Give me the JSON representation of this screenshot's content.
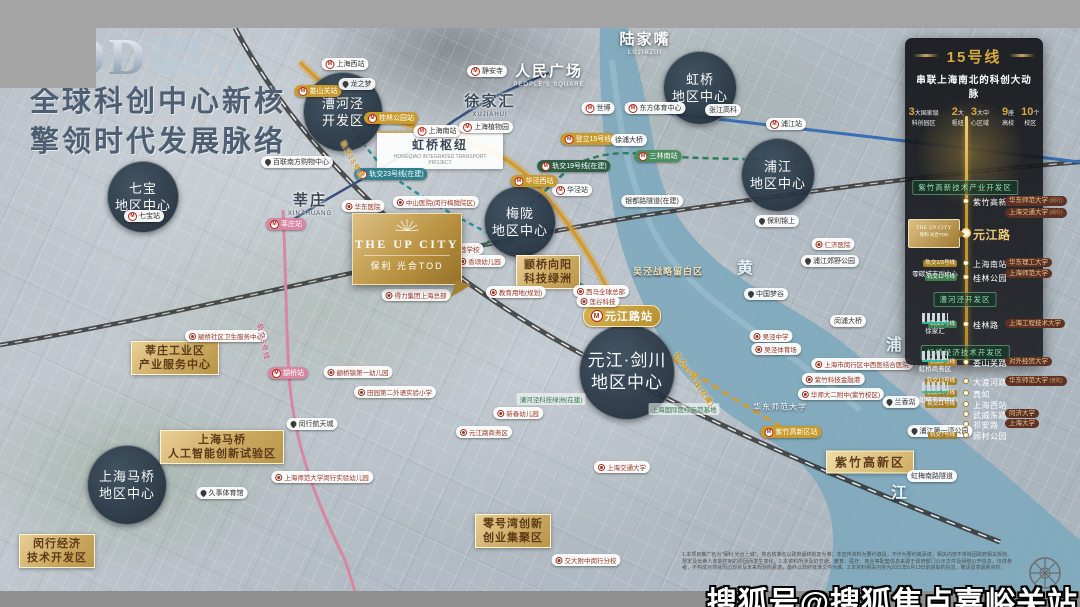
{
  "colors": {
    "gold": "#c9a227",
    "panel_bg": "#16181c",
    "circle_bg": "#22303d",
    "line15": "#d49a2e",
    "line5": "#d887a2",
    "river": "#7fa9bd",
    "green_label": "#2f7d4f",
    "red_label": "#9c3320"
  },
  "title": {
    "tod": "TOD",
    "the": "THE",
    "upcity": "UPCITY",
    "line1": "全球科创中心新核",
    "line2": "擎领时代发展脉络"
  },
  "project_logo": {
    "en": "THE UP CITY",
    "cn": "保利 光合TOD",
    "icon": "sunburst-icon"
  },
  "watermark": "搜狐号@搜狐焦点嘉峪关站",
  "disclaimer": "1.本项目推广名为“保利·光合上城”，地名核准名以政府最终批复为准；本宣传资料为要约邀请，不作为要约或承诺，相关内容不排除因政府相关规划、规定及出卖人未能控制的原因而发生变化。2.本资料所涉及的交通、教育、医疗、商业等配套信息来源于政府部门公示文件及网络公开信息，仅供参考，不构成对项目周边现状及未来规划的承诺，最终以政府批准文件为准。3.本资料相关内容为2021年6月13日前获取的信息，敬请留意最新资料。",
  "panel": {
    "title": "15号线",
    "subtitle": "串联上海南北的科创大动脉",
    "stats": [
      {
        "num": "3",
        "unit": "大国家级",
        "label": "科创园区"
      },
      {
        "num": "2",
        "unit": "大",
        "label": "枢纽"
      },
      {
        "num": "3",
        "unit": "大中",
        "label": "心区域"
      },
      {
        "num": "9",
        "unit": "座",
        "label": "高校"
      },
      {
        "num": "10",
        "unit": "个",
        "label": "校区"
      }
    ],
    "logo": {
      "en": "THE UP CITY",
      "cn": "保利 光合TOD"
    },
    "rows": [
      {
        "kind": "zone",
        "y": 72,
        "text": "紫竹高新技术产业开发区"
      },
      {
        "kind": "station",
        "y": 88,
        "name": "紫竹高新区",
        "pills": [
          {
            "t": "华东师范大学",
            "s": "(闵行)"
          },
          {
            "t": "上海交通大学",
            "s": "(闵行)"
          }
        ]
      },
      {
        "kind": "station",
        "y": 120,
        "name": "元江路",
        "big": true,
        "logo": true
      },
      {
        "kind": "station",
        "y": 150,
        "name": "上海南站",
        "tag": {
          "t": "轨交1/3号线",
          "c": "gold"
        },
        "left": "零碳城市副中心",
        "pills": [
          {
            "t": "华东理工大学"
          },
          {
            "t": "上海师范大学"
          }
        ]
      },
      {
        "kind": "station",
        "y": 164,
        "name": "桂林公园",
        "tag": {
          "t": "轨交12号线",
          "c": "green"
        }
      },
      {
        "kind": "zone",
        "y": 184,
        "text": "漕河泾开发区"
      },
      {
        "kind": "station",
        "y": 211,
        "name": "桂林路",
        "tag": {
          "t": "轨交9号线",
          "c": "green"
        },
        "lefticon": "徐家汇",
        "pills": [
          {
            "t": "上海工程技术大学"
          }
        ]
      },
      {
        "kind": "zone",
        "y": 237,
        "text": "虹桥经济技术开发区"
      },
      {
        "kind": "station",
        "y": 249,
        "name": "娄山关路",
        "tag": {
          "t": "轨交2号线",
          "c": "gold"
        },
        "lefticon": "虹桥商务区",
        "pills": [
          {
            "t": "对外经贸大学"
          }
        ]
      },
      {
        "kind": "station",
        "y": 268,
        "name": "大渡河路",
        "tag": {
          "t": "轨交13号线",
          "c": "gold"
        },
        "pills": [
          {
            "t": "华东师范大学",
            "s": "(普陀)"
          }
        ]
      },
      {
        "kind": "station",
        "y": 280,
        "name": "真如",
        "tag": {
          "t": "轨交14号线",
          "c": "gold"
        },
        "lefticon": "真如城市副中心"
      },
      {
        "kind": "station",
        "y": 291,
        "name": "上海西站",
        "tag": {
          "t": "轨交11号线",
          "c": "gold"
        }
      },
      {
        "kind": "station",
        "y": 301,
        "name": "武威东路",
        "pills": [
          {
            "t": "同济大学"
          }
        ]
      },
      {
        "kind": "station",
        "y": 311,
        "name": "祁安路",
        "pills": [
          {
            "t": "上海大学"
          }
        ]
      },
      {
        "kind": "station",
        "y": 322,
        "name": "顾村公园",
        "tag": {
          "t": "轨交7号线",
          "c": "gold"
        }
      }
    ]
  },
  "map": {
    "labels": [
      {
        "k": "circle",
        "t": "虹桥\n地区中心",
        "x": 700,
        "y": 88,
        "r": 37,
        "n": "circle-hongqiao-center"
      },
      {
        "k": "circle",
        "t": "漕河泾\n开发区",
        "x": 343,
        "y": 112,
        "r": 40,
        "n": "circle-caohejing"
      },
      {
        "k": "circle",
        "t": "七宝\n地区中心",
        "x": 143,
        "y": 197,
        "r": 36,
        "n": "circle-qibao-center"
      },
      {
        "k": "circle",
        "t": "梅陇\n地区中心",
        "x": 520,
        "y": 222,
        "r": 36,
        "n": "circle-meilong-center"
      },
      {
        "k": "circle",
        "t": "浦江\n地区中心",
        "x": 778,
        "y": 175,
        "r": 37,
        "n": "circle-pujiang-center"
      },
      {
        "k": "circle",
        "t": "元江·剑川\n地区中心",
        "x": 627,
        "y": 372,
        "r": 48,
        "lg": true,
        "n": "circle-yuanjiang-jianchuan-center"
      },
      {
        "k": "circle",
        "t": "上海马桥\n地区中心",
        "x": 127,
        "y": 485,
        "r": 40,
        "n": "circle-maqiao-center"
      },
      {
        "k": "cwhite",
        "t": "陆家嘴",
        "e": "LUJIAZUI",
        "x": 645,
        "y": 42,
        "n": "label-lujiazui"
      },
      {
        "k": "cwhite",
        "t": "人民广场",
        "e": "PEOPLE'S SQUARE",
        "x": 549,
        "y": 74,
        "n": "label-peoples-square"
      },
      {
        "k": "cdark",
        "t": "徐家汇",
        "e": "XUJIAHUI",
        "x": 490,
        "y": 104,
        "n": "label-xujiahui"
      },
      {
        "k": "cdark",
        "t": "莘庄",
        "e": "XINZHUANG",
        "x": 310,
        "y": 203,
        "n": "label-xinzhuang"
      },
      {
        "k": "white",
        "t": "张江高科",
        "x": 723,
        "y": 110,
        "n": "label-zhangjiang-hi-tech"
      },
      {
        "k": "hub",
        "t": "虹桥枢纽",
        "e": "HONGQIAO INTEGRATED TRANSPORT PROJECT",
        "x": 440,
        "y": 150,
        "n": "label-hongqiao-hub"
      },
      {
        "k": "gbox",
        "t": "莘庄工业区\n产业服务中心",
        "x": 175,
        "y": 358,
        "n": "zone-xinzhuang-industrial"
      },
      {
        "k": "gbox",
        "t": "上海马桥\n人工智能创新试验区",
        "x": 222,
        "y": 447,
        "n": "zone-maqiao-ai"
      },
      {
        "k": "gbox",
        "t": "颛桥向阳\n科技绿洲",
        "x": 548,
        "y": 272,
        "n": "zone-zhuanqiao-xiangyang"
      },
      {
        "k": "gbox",
        "t": "零号湾创新\n创业集聚区",
        "x": 513,
        "y": 531,
        "n": "zone-lingang-zero-bay"
      },
      {
        "k": "gbox",
        "t": "闵行经济\n技术开发区",
        "x": 57,
        "y": 551,
        "n": "zone-minhang-etdz"
      },
      {
        "k": "gline",
        "t": "紫竹高新区",
        "x": 870,
        "y": 462,
        "n": "zone-zizhu-hi-tech"
      },
      {
        "k": "metro",
        "c": "w",
        "t": "上海西站",
        "x": 345,
        "y": 64,
        "n": "station-shanghai-west"
      },
      {
        "k": "metro",
        "c": "w",
        "t": "静安寺",
        "x": 487,
        "y": 71,
        "n": "station-jingansi"
      },
      {
        "k": "metro",
        "c": "w",
        "t": "上海南站",
        "x": 437,
        "y": 131,
        "n": "station-shanghai-south"
      },
      {
        "k": "metro",
        "c": "w",
        "t": "上海植物园",
        "x": 486,
        "y": 127,
        "n": "station-botanical-garden"
      },
      {
        "k": "metro",
        "c": "w",
        "t": "世博",
        "x": 598,
        "y": 108,
        "n": "station-expo"
      },
      {
        "k": "metro",
        "c": "w",
        "t": "东方体育中心",
        "x": 655,
        "y": 108,
        "n": "station-oriental-sports-center"
      },
      {
        "k": "metro",
        "c": "w",
        "t": "七宝站",
        "x": 144,
        "y": 216,
        "n": "station-qibao"
      },
      {
        "k": "metro",
        "c": "w",
        "t": "浦江站",
        "x": 786,
        "y": 124,
        "n": "station-pujiang"
      },
      {
        "k": "metro",
        "c": "w",
        "t": "华泾站",
        "x": 572,
        "y": 190,
        "n": "station-huajing"
      },
      {
        "k": "metro",
        "c": "g",
        "t": "娄山关站",
        "x": 318,
        "y": 91,
        "n": "station-loushanguan"
      },
      {
        "k": "metro",
        "c": "g",
        "t": "桂林公园站",
        "x": 391,
        "y": 118,
        "n": "station-guilin-park"
      },
      {
        "k": "metro",
        "c": "g",
        "t": "华泾西站",
        "x": 534,
        "y": 181,
        "n": "station-huajing-west"
      },
      {
        "k": "metro",
        "c": "g",
        "t": "紫竹高新区站",
        "x": 791,
        "y": 432,
        "n": "station-zizhu-hi-tech"
      },
      {
        "k": "metro",
        "c": "g",
        "t": "登立15号线",
        "x": 588,
        "y": 139,
        "n": "callout-line15"
      },
      {
        "k": "metro",
        "c": "p",
        "t": "莘庄站",
        "x": 286,
        "y": 224,
        "n": "station-xinzhuang"
      },
      {
        "k": "metro",
        "c": "p",
        "t": "颛桥站",
        "x": 288,
        "y": 373,
        "n": "station-zhuanqiao"
      },
      {
        "k": "metro",
        "c": "gr",
        "t": "三林南站",
        "x": 658,
        "y": 156,
        "n": "station-sanlin-south"
      },
      {
        "k": "metro",
        "c": "dg",
        "t": "轨交19号线(在建)",
        "x": 574,
        "y": 166,
        "n": "line19-under-construction"
      },
      {
        "k": "metro",
        "c": "tl",
        "t": "轨交23号线(在建)",
        "x": 391,
        "y": 174,
        "n": "line23-under-construction"
      },
      {
        "k": "metro",
        "c": "big",
        "t": "元江路站",
        "x": 622,
        "y": 316,
        "n": "station-yuanjiang-road"
      },
      {
        "k": "white",
        "t": "徐浦大桥",
        "x": 629,
        "y": 140,
        "n": "label-xupu-bridge"
      },
      {
        "k": "white",
        "t": "银都路隧道(在建)",
        "x": 652,
        "y": 201,
        "n": "label-yindu-tunnel"
      },
      {
        "k": "white",
        "t": "闵浦大桥",
        "x": 848,
        "y": 321,
        "n": "label-minpu-bridge"
      },
      {
        "k": "white",
        "t": "虹梅南路隧道",
        "x": 932,
        "y": 476,
        "n": "label-hongmei-tunnel"
      },
      {
        "k": "white",
        "t": "颛桥剪纸文化公园",
        "x": 401,
        "y": 277,
        "ic": 1,
        "n": "label-zhuanqiao-papercut-park"
      },
      {
        "k": "pin",
        "t": "龙之梦",
        "x": 357,
        "y": 84,
        "n": "poi-longemont"
      },
      {
        "k": "pin",
        "t": "百联南方购物中心",
        "x": 297,
        "y": 162,
        "n": "poi-bailian-south"
      },
      {
        "k": "pin",
        "t": "保利锦上",
        "x": 777,
        "y": 221,
        "n": "poi-poly-jinshang"
      },
      {
        "k": "pin",
        "t": "浦江郊野公园",
        "x": 830,
        "y": 261,
        "n": "poi-pujiang-country-park"
      },
      {
        "k": "pin",
        "t": "中国梦谷",
        "x": 766,
        "y": 294,
        "n": "poi-china-dream-valley"
      },
      {
        "k": "pin",
        "t": "兰香湖",
        "x": 901,
        "y": 402,
        "n": "poi-lanxiang-lake"
      },
      {
        "k": "pin",
        "t": "浦江第一湾公园",
        "x": 940,
        "y": 431,
        "n": "poi-first-bend-park"
      },
      {
        "k": "pin",
        "t": "久事体育馆",
        "x": 222,
        "y": 493,
        "n": "poi-jiushi-stadium"
      },
      {
        "k": "pin",
        "t": "闵行航天城",
        "x": 312,
        "y": 424,
        "n": "poi-minhang-space-city"
      },
      {
        "k": "red",
        "t": "中山医院(闵行梅陇院区)",
        "x": 436,
        "y": 202,
        "n": "poi-zhongshan-hospital"
      },
      {
        "k": "red",
        "t": "华东医院",
        "x": 363,
        "y": 206,
        "n": "poi-huadong-hospital"
      },
      {
        "k": "red",
        "t": "君莲学校",
        "x": 462,
        "y": 249,
        "n": "poi-junlian-school"
      },
      {
        "k": "red",
        "t": "香颂幼儿园",
        "x": 480,
        "y": 261,
        "n": "poi-xiangsong-kindergarten"
      },
      {
        "k": "red",
        "t": "教育用地(规划)",
        "x": 516,
        "y": 292,
        "n": "poi-education-land"
      },
      {
        "k": "red",
        "t": "颛桥社区卫生服务中心",
        "x": 226,
        "y": 336,
        "n": "poi-zhuanqiao-health-center"
      },
      {
        "k": "red",
        "t": "颛桥镇第一幼儿园",
        "x": 358,
        "y": 372,
        "n": "poi-zhuanqiao-first-kindergarten"
      },
      {
        "k": "red",
        "t": "田园第二外语实验小学",
        "x": 395,
        "y": 392,
        "n": "poi-tianyuan-school"
      },
      {
        "k": "red",
        "t": "上海师范大学闵行实验幼儿园",
        "x": 322,
        "y": 477,
        "n": "poi-shnu-kindergarten"
      },
      {
        "k": "red",
        "t": "交大附中闵行分校",
        "x": 586,
        "y": 560,
        "n": "poi-jiaoda-affiliated-school"
      },
      {
        "k": "red",
        "t": "上海交通大学",
        "x": 622,
        "y": 467,
        "n": "poi-sjtu"
      },
      {
        "k": "red",
        "t": "仁济医院",
        "x": 833,
        "y": 244,
        "n": "poi-renji-hospital"
      },
      {
        "k": "red",
        "t": "吴泾中学",
        "x": 771,
        "y": 336,
        "n": "poi-wujing-middle-school"
      },
      {
        "k": "red",
        "t": "吴泾体育场",
        "x": 776,
        "y": 349,
        "n": "poi-wujing-stadium"
      },
      {
        "k": "red",
        "t": "上海市闵行区中西医结合医院",
        "x": 862,
        "y": 364,
        "n": "poi-minhang-tcm-hospital"
      },
      {
        "k": "red",
        "t": "紫竹科技金融港",
        "x": 833,
        "y": 379,
        "n": "poi-zizhu-fintech-port"
      },
      {
        "k": "red",
        "t": "华师大二附中(紫竹校区)",
        "x": 841,
        "y": 394,
        "n": "poi-hsd-no2-school"
      },
      {
        "k": "red",
        "t": "新春幼儿园",
        "x": 518,
        "y": 413,
        "n": "poi-xinchun-kindergarten"
      },
      {
        "k": "red",
        "t": "西马全球总部",
        "x": 601,
        "y": 291,
        "n": "poi-xima-hq"
      },
      {
        "k": "red",
        "t": "莲谷科技",
        "x": 598,
        "y": 301,
        "n": "poi-liangu-tech"
      },
      {
        "k": "red",
        "t": "得力集团上海总部",
        "x": 416,
        "y": 295,
        "n": "poi-deli-hq"
      },
      {
        "k": "red",
        "t": "元江路商务区",
        "x": 484,
        "y": 432,
        "n": "poi-yuanjiang-business-district"
      },
      {
        "k": "green",
        "t": "漕河泾科技绿洲(在建)",
        "x": 551,
        "y": 399,
        "n": "label-caohejing-tech-oasis"
      },
      {
        "k": "green",
        "t": "上海国际医疗示范基地",
        "x": 684,
        "y": 409,
        "n": "label-medical-demo-base"
      },
      {
        "k": "tan",
        "t": "吴泾战略留白区",
        "x": 668,
        "y": 271,
        "n": "label-wujing-reserved-area"
      },
      {
        "k": "wtext",
        "t": "华东师范大学",
        "x": 780,
        "y": 407,
        "n": "label-ecnu"
      },
      {
        "k": "rot",
        "c": "gold",
        "t": "轨交15号线",
        "x": 352,
        "y": 160,
        "rot": 62,
        "n": "line15-name"
      },
      {
        "k": "rot",
        "c": "gold",
        "t": "轨交15号线(在建)",
        "x": 694,
        "y": 380,
        "rot": 55,
        "n": "line15-south-extension"
      },
      {
        "k": "rot",
        "c": "pink",
        "t": "轨交5号线",
        "x": 263,
        "y": 342,
        "rot": 78,
        "n": "line5-name"
      },
      {
        "k": "river",
        "t": "黄",
        "x": 745,
        "y": 266,
        "n": "river-char-huang"
      },
      {
        "k": "river",
        "t": "浦",
        "x": 894,
        "y": 343,
        "n": "river-char-pu"
      },
      {
        "k": "river",
        "t": "江",
        "x": 899,
        "y": 491,
        "n": "river-char-jiang"
      }
    ]
  }
}
